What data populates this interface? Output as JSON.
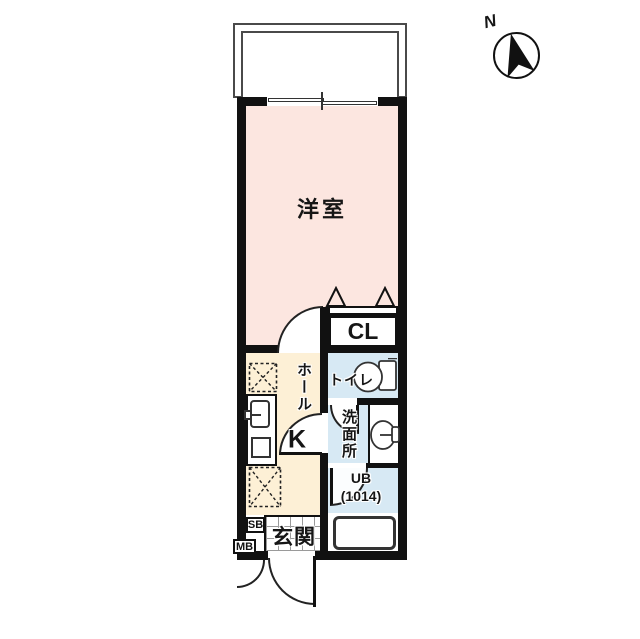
{
  "plan": {
    "type": "apartment-floor-plan",
    "compass": {
      "north_label": "N"
    },
    "rooms": {
      "western_room": "洋室",
      "closet": "CL",
      "toilet": "トイレ",
      "washroom": "洗面所",
      "hall": "ホール",
      "kitchen": "K",
      "unit_bath_l1": "UB",
      "unit_bath_l2": "(1014)",
      "entrance": "玄関",
      "shoe_box": "SB",
      "meter_box": "MB"
    },
    "colors": {
      "western_room_pink": "#fce6e0",
      "hall_kitchen_cream": "#fdf0d6",
      "wet_area_blue": "#d7e9f4",
      "wall_black": "#111111",
      "balcony_line_gray": "#4a4a4a",
      "background": "#ffffff"
    }
  }
}
